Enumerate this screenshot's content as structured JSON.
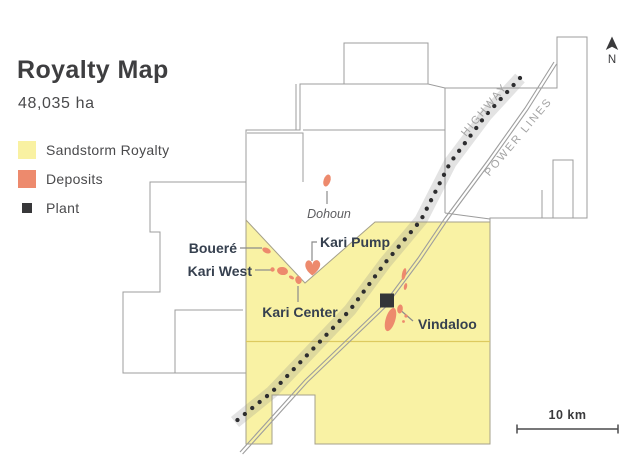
{
  "header": {
    "title": "Royalty Map",
    "area": "48,035 ha"
  },
  "legend": {
    "royalty": "Sandstorm Royalty",
    "deposits": "Deposits",
    "plant": "Plant"
  },
  "map": {
    "labels": {
      "dohoun": "Dohoun",
      "bouere": "Boueré",
      "kari_west": "Kari West",
      "kari_pump": "Kari Pump",
      "kari_center": "Kari Center",
      "vindaloo": "Vindaloo"
    },
    "infrastructure": {
      "highway": "HIGHWAY",
      "power_lines": "POWER LINES"
    },
    "north_label": "N",
    "scale_label": "10 km"
  },
  "colors": {
    "royalty_fill": "#f9f2a4",
    "deposit": "#ed8a6d",
    "plant": "#38383a",
    "parcel_outline": "#9c9c9c",
    "label_dark": "#36404f"
  }
}
